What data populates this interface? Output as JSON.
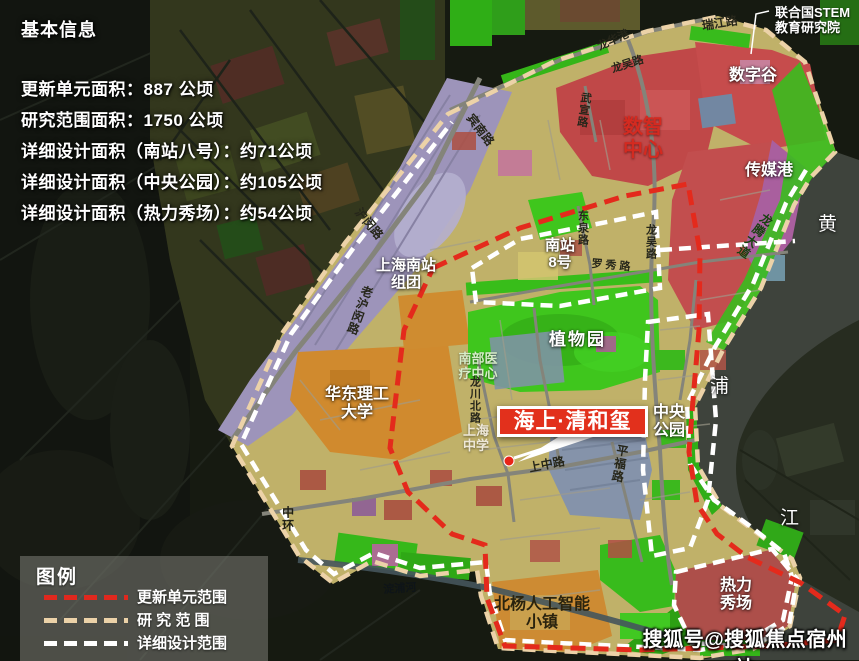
{
  "info_panel": {
    "title": "基本信息",
    "stats": [
      "更新单元面积：887 公顷",
      "研究范围面积：1750 公顷",
      "详细设计面积（南站八号）：约71公顷",
      "详细设计面积（中央公园）：约105公顷",
      "详细设计面积（热力秀场）：约54公顷"
    ]
  },
  "annotation": {
    "text": "联合国STEM\n教育研究院"
  },
  "site_marker": {
    "label": "海上·清和玺"
  },
  "legend": {
    "title": "图例",
    "items": [
      {
        "label": "更新单元范围",
        "color": "#e0281e"
      },
      {
        "label": "研 究 范 围",
        "color": "#ecd2a8"
      },
      {
        "label": "详细设计范围",
        "color": "#ffffff"
      }
    ]
  },
  "watermark": {
    "text": "搜狐号@搜狐焦点宿州站"
  },
  "map_labels": {
    "ruijiang_road": "瑞江路",
    "longhua_port": "龙华港",
    "longwu_road_north": "龙吴路",
    "digital_valley": "数字谷",
    "digital_intelligence_center": "数智\n中心",
    "media_port": "传媒港",
    "wuxuan_road": "武宣路",
    "binnan_road": "宾南路",
    "humin_road": "沪闵路",
    "south_station_cluster": "上海南站\n组团",
    "lao_humin_road": "老沪闵路",
    "south_station_no8": "南站\n8号",
    "dongquan_road": "东泉路",
    "luoxiu_road": "罗秀路",
    "longwu_road_east": "龙吴路",
    "botanical_garden": "植物园",
    "south_medical_center": "南部医\n疗中心",
    "ecust_university": "华东理工\n大学",
    "longchuan_north_road": "龙川北路",
    "shanghai_high_school": "上海\n中学",
    "shangzhong_road": "上中路",
    "pingfu_road": "平福路",
    "central_park": "中央\n公园",
    "middle_ring": "中环",
    "dianpu_river": "淀浦河",
    "beiyang_ai_town": "北杨人工智能\n小镇",
    "thermal_show_ground": "热力\n秀场",
    "huangpu_char1": "黄",
    "huangpu_char2": "浦",
    "huangpu_char3": "江",
    "longteng_avenue": "龙腾大道"
  },
  "colors": {
    "update_unit_boundary": "#e0281e",
    "research_boundary": "#ecd2a8",
    "detail_design_boundary": "#ffffff",
    "site_box": "#e2301c",
    "park_green": "#3fc61d",
    "commercial_red": "#c24e4e",
    "rail_corridor_purple": "#9d94ba",
    "campus_orange": "#d08a2e",
    "base_khaki": "#c0b169"
  }
}
